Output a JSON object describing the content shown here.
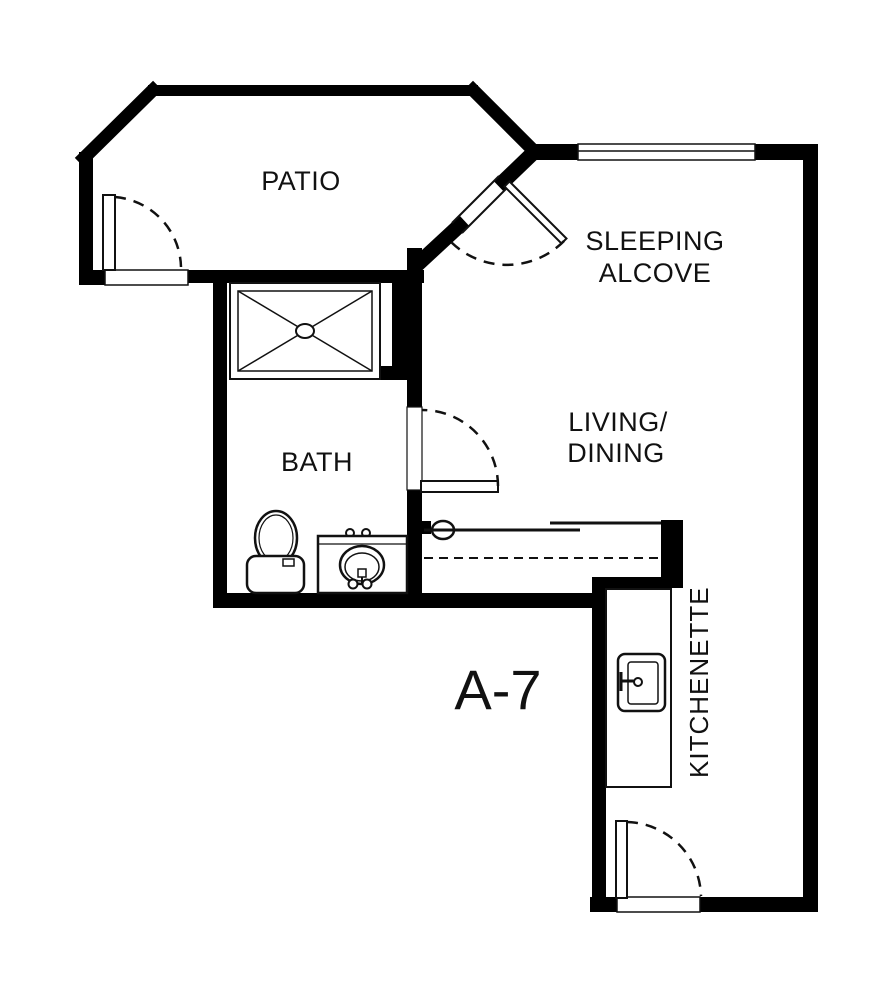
{
  "document": {
    "type": "apartment-floor-plan",
    "unit_label": "A-7"
  },
  "rooms": {
    "patio": {
      "label": "PATIO"
    },
    "sleeping_alcove": {
      "line1": "SLEEPING",
      "line2": "ALCOVE"
    },
    "living_dining": {
      "line1": "LIVING/",
      "line2": "DINING"
    },
    "bath": {
      "label": "BATH"
    },
    "kitchenette": {
      "label": "KITCHENETTE"
    }
  },
  "fixtures": {
    "shower": "shower-pan-with-drain",
    "toilet": "toilet",
    "vanity": "vanity-with-oval-sink",
    "kitchen_sink": "kitchen-sink",
    "closet_doors": "bypass-sliding-doors",
    "counter_overhead": "dashed-overhead-counter-line"
  },
  "doors": {
    "patio_door": "hinged-door-swing",
    "alcove_door": "hinged-door-swing-diagonal",
    "bath_door": "hinged-door-swing",
    "entry_door": "hinged-door-swing"
  },
  "windows": {
    "alcove_window": "window-in-wall"
  },
  "colors": {
    "wall": "#000000",
    "background": "#ffffff",
    "line": "#111111"
  }
}
